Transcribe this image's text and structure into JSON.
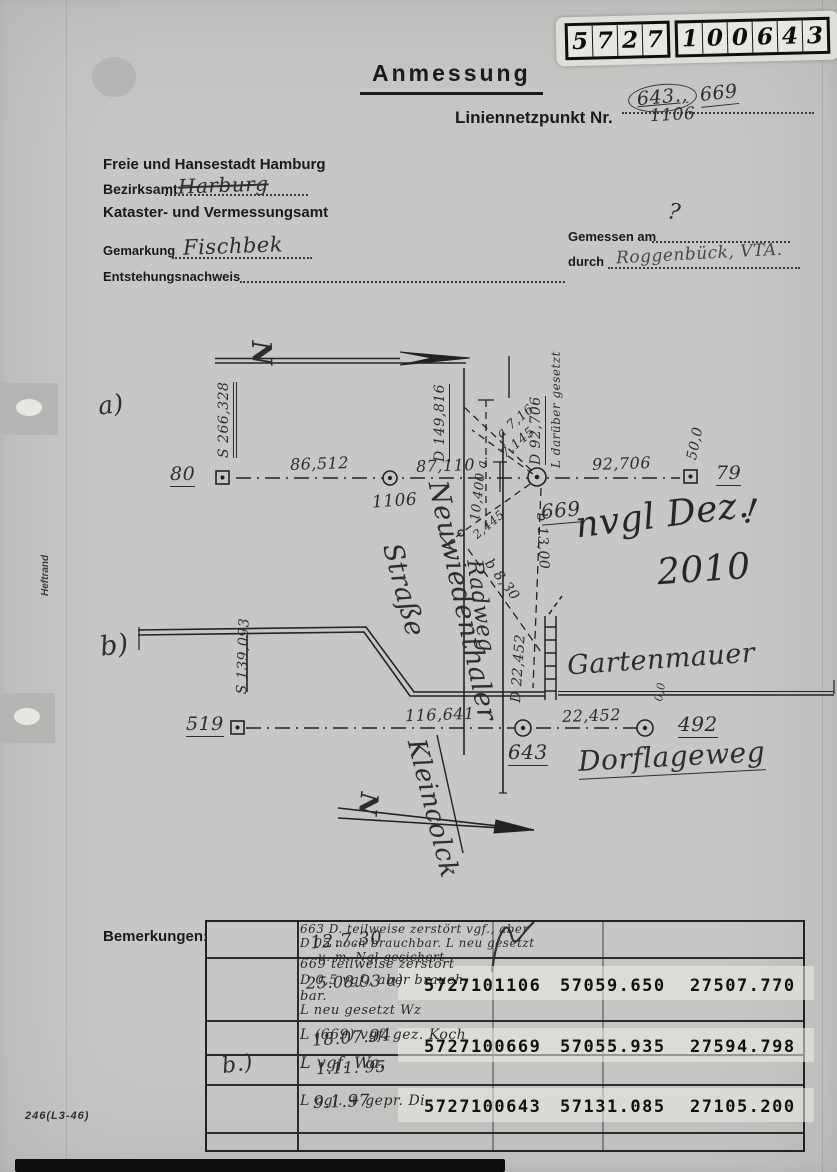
{
  "stamp": {
    "digits": [
      "5",
      "7",
      "2",
      "7",
      "1",
      "0",
      "0",
      "6",
      "4",
      "3"
    ]
  },
  "header": {
    "title": "Anmessung",
    "point_label": "Liniennetzpunkt Nr.",
    "point_circled": "643.,",
    "point_circled2": "669",
    "point_value": "1106",
    "city": "Freie und Hansestadt Hamburg",
    "district_label": "Bezirksamt",
    "district_value": "Harburg",
    "office": "Kataster- und Vermessungsamt",
    "gemarkung_label": "Gemarkung",
    "gemarkung_value": "Fischbek",
    "origin_label": "Entstehungsnachweis",
    "measured_label": "Gemessen am",
    "measured_value": "?",
    "by_label": "durch",
    "by_value": "Roggenbück, VTA."
  },
  "sketch": {
    "label_a": "a)",
    "label_b": "b)",
    "north": "N",
    "pt_80": "80",
    "pt_79": "79",
    "pt_1106": "1106",
    "pt_669": "669",
    "pt_519": "519",
    "pt_643": "643",
    "pt_492": "492",
    "dist_80_1106": "86,512",
    "dist_1106_669": "87,110",
    "dist_669_79": "92,706",
    "dist_519_643": "116,641",
    "dist_643_492": "22,452",
    "rot_s266": "S 266,328",
    "rot_d149": "D 149,816",
    "rot_d92": "D 92,706",
    "rot_l_daruber": "L darüber gesetzt",
    "rot_50": "50,0",
    "rot_s139": "S 139,093",
    "rot_d22": "D 22,452",
    "rot_00": "0,0",
    "off_10400": "10,400 a.",
    "off_a716": "a 7,16",
    "off_7145": "7,145",
    "off_2445": "2,445",
    "off_b1300": "b 13,00",
    "off_b830": "b 8,30",
    "street_neuwiedenthaler_1": "Neuwiedenthaler",
    "street_neuwiedenthaler_2": "Straße",
    "street_radweg": "Radweg",
    "wall_label": "Gartenmauer",
    "street_dorflageweg": "Dorflageweg",
    "street_klein": "Kleincolck",
    "note_1": "nvgl Dez.",
    "note_2": "2010",
    "note_3": "!"
  },
  "remarks": {
    "label": "Bemerkungen:",
    "side_label": "b.)",
    "rows": [
      {
        "date": "12.7.30",
        "lines": [
          "663   D. teilweise zerstört vgf., aber",
          "D 05   noch brauchbar. L neu gesetzt",
          "u. m. Ngl gesichert"
        ]
      },
      {
        "date": "25.08.93  a)",
        "lines": [
          "669   teilweise zerstört",
          "D 0,5   vgf., aber brauch-",
          "bar.",
          "L neu gesetzt   Wz"
        ]
      },
      {
        "date": "18.07.94",
        "lines": [
          "L (669) vgf.   gez. Koch"
        ]
      },
      {
        "date": "1.11. 95",
        "lines": [
          "L vgf.   Wa."
        ]
      },
      {
        "date": "9.1.97",
        "lines": [
          "L ogl. + gepr.  Di"
        ]
      }
    ]
  },
  "coords": {
    "rows": [
      [
        "5727101106",
        "57059.650",
        "27507.770"
      ],
      [
        "5727100669",
        "57055.935",
        "27594.798"
      ],
      [
        "5727100643",
        "57131.085",
        "27105.200"
      ]
    ]
  },
  "footer": {
    "form_code": "246(L3-46)",
    "margin_label": "Heftrand"
  }
}
